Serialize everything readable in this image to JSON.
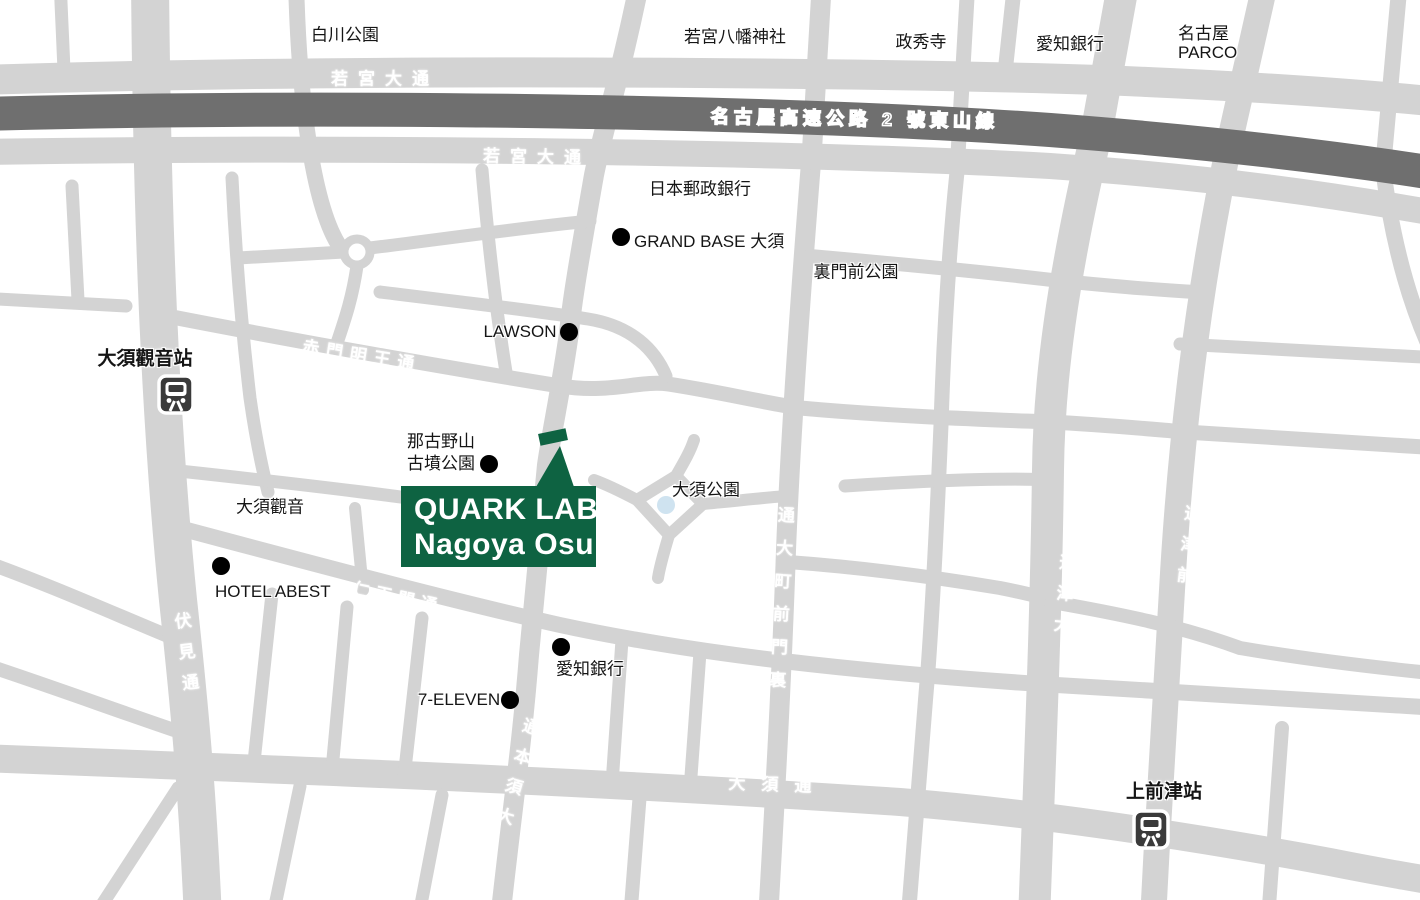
{
  "colors": {
    "road": "#d3d3d3",
    "expressway": "#6f6f6f",
    "brand_green": "#0e6342",
    "pond_blue": "#cfe3f0",
    "poi_dot": "#000000",
    "station_icon": "#3a3a3a",
    "label_text": "#151515",
    "road_label_text": "#ffffff"
  },
  "location_box": {
    "line1": "QUARK LAB",
    "line2": "Nagoya Osu"
  },
  "stations": {
    "osu_kannon": "大須觀音站",
    "kamimaezu": "上前津站"
  },
  "area_labels": {
    "shirakawa_park": "白川公園",
    "wakamiya_hachiman": "若宮八幡神社",
    "seishuji": "政秀寺",
    "aichi_bank_north": "愛知銀行",
    "nagoya_parco_line1": "名古屋",
    "nagoya_parco_line2": "PARCO",
    "japan_post_bank": "日本郵政銀行",
    "grand_base": "GRAND BASE 大須",
    "uramonzen_park": "裏門前公園",
    "lawson": "LAWSON",
    "nagonoyama_line1": "那古野山",
    "nagonoyama_line2": "古墳公園",
    "osu_kannon_temple": "大須觀音",
    "osu_park": "大須公園",
    "hotel_abest": "HOTEL ABEST",
    "aichi_bank_south": "愛知銀行",
    "seven_eleven": "7-ELEVEN"
  },
  "road_labels": {
    "expressway": "名古屋高速公路 2 號東山線",
    "wakamiya_odori_north": "若宮大通",
    "wakamiya_odori_south": "若宮大通",
    "akamon_myoo_dori": "赤門明王通",
    "fushimi_dori": "伏見通",
    "niomon_dori": "仁王門通",
    "osu_hon_dori": "大須本通",
    "uramonzencho_odori": "裏門前町大通",
    "otsu_dori": "大津通",
    "maezu_dori": "前津通",
    "osu_dori": "大須通"
  }
}
